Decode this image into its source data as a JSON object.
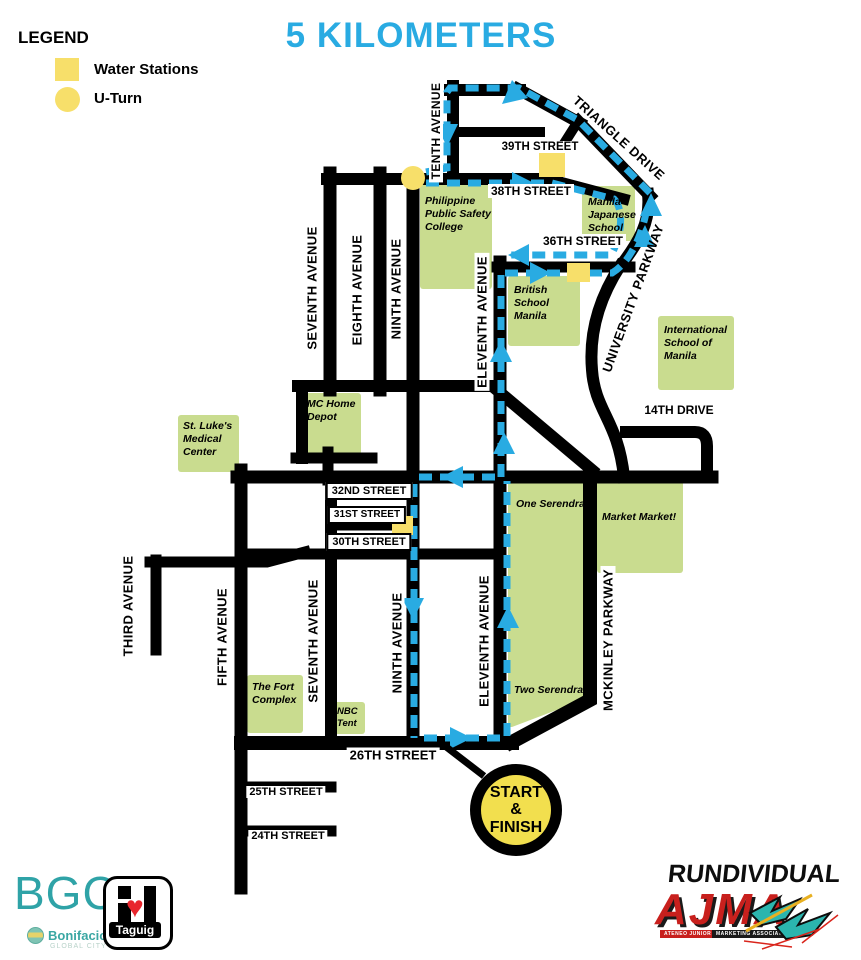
{
  "title": "5 KILOMETERS",
  "legend": {
    "heading": "LEGEND",
    "water_label": "Water Stations",
    "uturn_label": "U-Turn"
  },
  "streets": {
    "tenth": "TENTH AVENUE",
    "seventh_upper": "SEVENTH AVENUE",
    "eighth": "EIGHTH AVENUE",
    "ninth_upper": "NINTH AVENUE",
    "eleventh_upper": "ELEVENTH AVENUE",
    "third": "THIRD AVENUE",
    "fifth": "FIFTH AVENUE",
    "seventh_lower": "SEVENTH AVENUE",
    "ninth_lower": "NINTH AVENUE",
    "eleventh_lower": "ELEVENTH AVENUE",
    "mckinley": "MCKINLEY PARKWAY",
    "university": "UNIVERSITY PARKWAY",
    "triangle": "TRIANGLE DRIVE",
    "s39": "39TH STREET",
    "s38": "38TH STREET",
    "s36": "36TH STREET",
    "d14": "14TH DRIVE",
    "s32": "32ND STREET",
    "s31": "31ST STREET",
    "s30": "30TH STREET",
    "s26": "26TH STREET",
    "s25": "25TH STREET",
    "s24": "24TH STREET"
  },
  "places": {
    "ppsc": "Philippine\nPublic Safety\nCollege",
    "mjs": "Manila\nJapanese\nSchool",
    "bsm": "British\nSchool\nManila",
    "ism": "International\nSchool of\nManila",
    "mc_home": "MC Home\nDepot",
    "st_lukes": "St. Luke's\nMedical\nCenter",
    "one_serendra": "One Serendra",
    "market_market": "Market Market!",
    "two_serendra": "Two Serendra",
    "fort": "The Fort\nComplex",
    "nbc": "NBC\nTent"
  },
  "start_finish": "START\n&\nFINISH",
  "logos": {
    "bgc": "BGC",
    "bonifacio": "Bonifacio",
    "global_city": "GLOBAL CITY",
    "taguig": "Taguig",
    "rundividual": "RUNDIVIDUAL",
    "ajma": "AJMA",
    "ajma_sub1": "ATENEO JUNIOR",
    "ajma_sub2": "MARKETING ASSOCIATION"
  },
  "colors": {
    "route": "#29ABE2",
    "road": "#000000",
    "building": "#C9DC8F",
    "marker": "#F7DF6A",
    "title": "#29ABE2",
    "bgc_teal": "#2FA3A7",
    "ajma_red": "#C8201D"
  }
}
